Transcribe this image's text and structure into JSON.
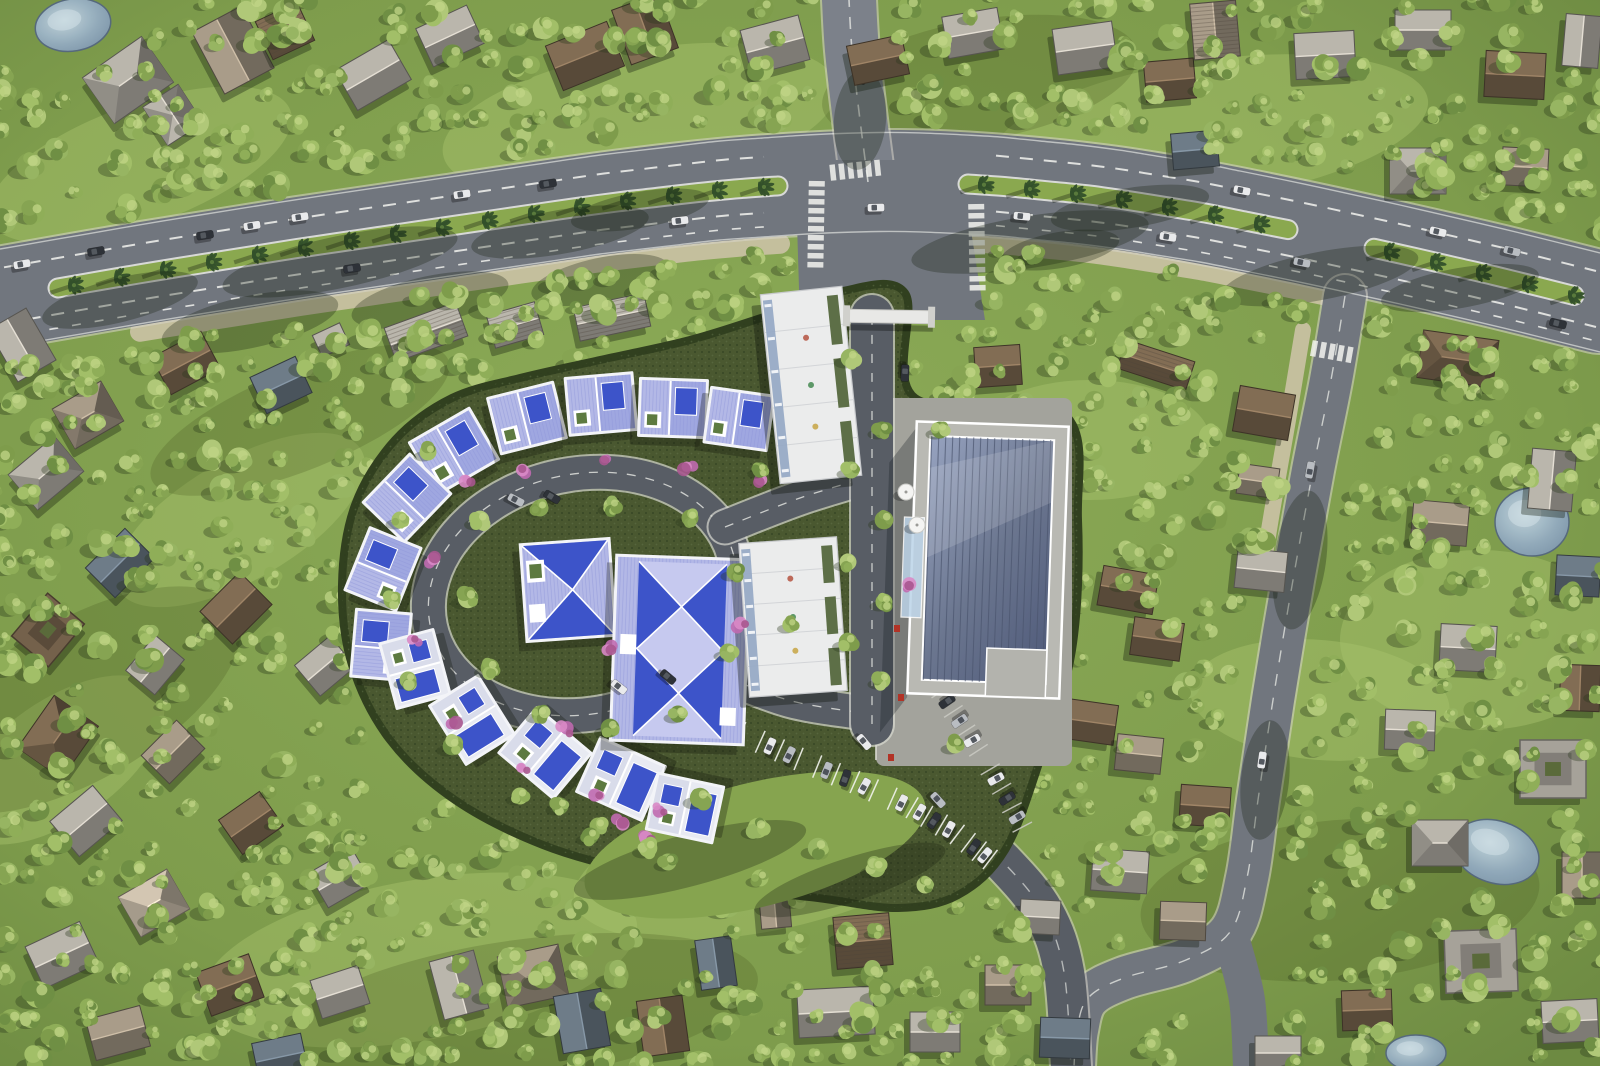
{
  "scene": {
    "type": "aerial-architectural-render",
    "description": "Top-down aerial 3D rendering of a gated residential development: an oval ring of blue-and-lavender roofed villas around a loop road, two white apartment slabs, a large hall with a blue solar-panel roof and plaza, a landscaped boulevard with palm-planted medians, surrounding tree-filled neighborhood with brown/gray roofed houses, several small ponds, curved streets, crosswalks and parked cars.",
    "time_of_day": "day"
  },
  "palette": {
    "grass": "#82a04f",
    "grass_dark": "#6a873f",
    "grass_light": "#a9c46d",
    "tree_greens": [
      "#7e9c4b",
      "#8fae58",
      "#a2bf68",
      "#6f8f44",
      "#97b562",
      "#86a452",
      "#b0c878"
    ],
    "tree_shadow": "#28361a",
    "asphalt": "#71767e",
    "asphalt_light": "#7c818a",
    "asphalt_dark": "#585d65",
    "curb": "#d8d6cb",
    "marking": "#f2f3ee",
    "sidewalk_tan": "#cbc2a5",
    "median_green": "#8aa84f",
    "palm_dark": "#33502a",
    "palm_center": "#597a3c",
    "plaza": "#a3a39c",
    "dev_ground": "#4a5830",
    "dev_dot": "#2e3c1e",
    "hedge": "#31401f",
    "fence_light": "#cfcfc5",
    "villa_white": "#f3f4f8",
    "villa_lavender": "#b3b8e6",
    "villa_lavender2": "#9fa7e0",
    "villa_blue": "#3d54c9",
    "villa_pale": "#e8eaf2",
    "villa_pale2": "#d9dcea",
    "apartment_white": "#ebecec",
    "roofgarden": "#5d6f47",
    "balcony_blue": "#93a7c4",
    "solar_light": "#97a3c0",
    "solar_dark": "#525d7c",
    "parapet": "#b9b9b3",
    "canopy_blue": "#bcd4e8",
    "pond_light": "#c3d6df",
    "pond_dark": "#7d95ac",
    "pond_rim": "#55687e",
    "roof_brown": "#6e5c47",
    "roof_darkbrown": "#57493a",
    "roof_taupe": "#8f8474",
    "roof_gray": "#9e9a92",
    "roof_bluegray": "#5d6973",
    "roof_beige": "#b3a897",
    "car_white": "#e9eaec",
    "car_silver": "#b9bdc2",
    "car_dark": "#2e3238",
    "car_red": "#a83326",
    "flower_pink": "#c06ab0",
    "flower_pink2": "#d98ac6",
    "accent_red": "#b23326",
    "gate_white": "#e8e8e6",
    "umbrella_white": "#f4f4f2"
  },
  "counts": {
    "outer_villas": 13,
    "inner_villas": 2,
    "apartment_buildings": 2,
    "solar_roof_buildings": 1,
    "ponds": 4,
    "entry_gates": 1,
    "cafe_umbrellas": 2,
    "crosswalks": 6,
    "median_segments": 3,
    "street_cars": 25,
    "parked_cars": 19
  }
}
